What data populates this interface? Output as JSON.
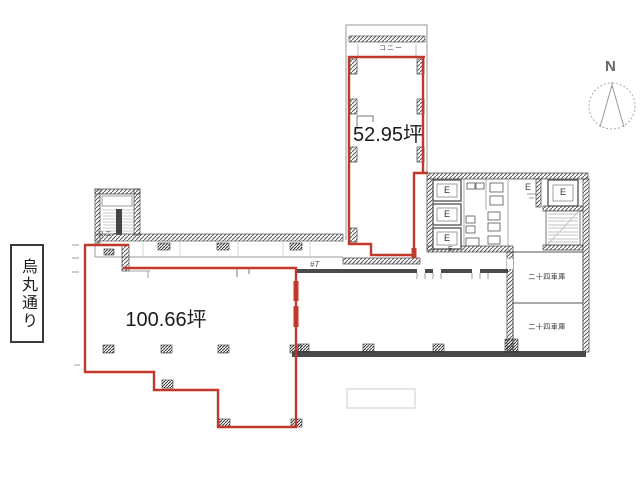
{
  "street_label": "烏丸通り",
  "area_labels": {
    "upper": "52.95坪",
    "lower": "100.66坪"
  },
  "balcony_labels": {
    "upper_wing": "コニー",
    "stairwell": "コニー"
  },
  "parking_rooms": {
    "upper": "二十四車庫",
    "lower": "二十四車庫"
  },
  "core": {
    "elevators": [
      "E",
      "E",
      "E"
    ],
    "small_e": "E",
    "eps": "E",
    "right_elevator": "E"
  },
  "compass_label": "N",
  "door_note": "#T",
  "colors": {
    "lease_boundary": "#c0392b",
    "wall": "#4a4a4a",
    "thin_line": "#999999"
  }
}
